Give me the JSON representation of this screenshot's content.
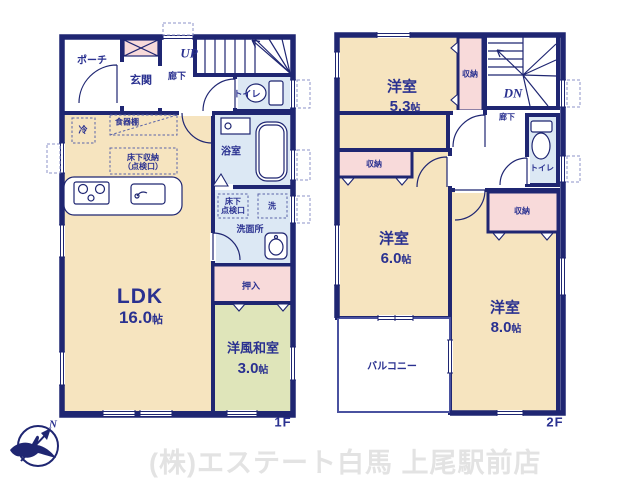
{
  "floor1": {
    "floor_label": "1F",
    "rooms": {
      "porch": "ポーチ",
      "genkan": "玄関",
      "up": "UP",
      "hallway": "廊下",
      "toilet": "トイレ",
      "fridge": "冷",
      "cupboard": "食器棚",
      "underfloor_storage_line1": "床下収納",
      "underfloor_storage_line2": "（点検口）",
      "bath": "浴室",
      "hatch_line1": "床下",
      "hatch_line2": "点検口",
      "laundry": "洗",
      "washroom": "洗面所",
      "oshiire": "押入",
      "ldk": "LDK",
      "ldk_size": "16.0",
      "ldk_unit": "帖",
      "washitsu": "洋風和室",
      "washitsu_size": "3.0",
      "washitsu_unit": "帖"
    }
  },
  "floor2": {
    "floor_label": "2F",
    "rooms": {
      "room53": "洋室",
      "room53_size": "5.3",
      "room53_unit": "帖",
      "closet_a": "収納",
      "dn": "DN",
      "hallway": "廊下",
      "toilet": "トイレ",
      "closet_b": "収納",
      "room60": "洋室",
      "room60_size": "6.0",
      "room60_unit": "帖",
      "closet_c": "収納",
      "room80": "洋室",
      "room80_size": "8.0",
      "room80_unit": "帖",
      "balcony": "バルコニー"
    }
  },
  "footer": {
    "company": "(株)エステート白馬 上尾駅前店",
    "north": "N"
  },
  "colors": {
    "wall": "#1f2672",
    "text": "#2a3190",
    "room_cream": "#f6e4bf",
    "room_green": "#dfe5ba",
    "closet_pink": "#f8dada",
    "wet_blue": "#dce8f4",
    "dash": "#8d93c8",
    "watermark": "#e3e3e3"
  }
}
